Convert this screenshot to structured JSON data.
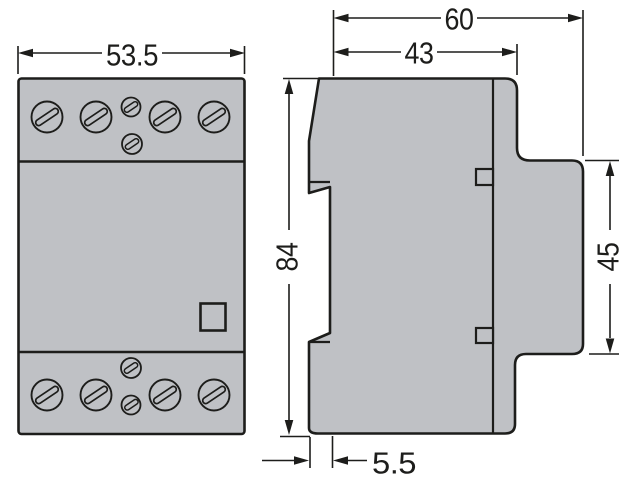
{
  "drawing": {
    "kind": "technical-dimension-drawing",
    "subject": "modular-contactor-outline",
    "colors": {
      "body_fill": "#bfc1c5",
      "line": "#1d1d1b",
      "background": "#ffffff"
    },
    "views": {
      "front": {
        "label": "front-view",
        "top_terminal_large_screws": 4,
        "top_terminal_small_screws": 2,
        "bottom_terminal_large_screws": 4,
        "bottom_terminal_small_screws": 2
      },
      "side": {
        "label": "side-view"
      }
    },
    "dimensions": {
      "front_width": "53.5",
      "side_overall_width": "60",
      "side_upper_width": "43",
      "side_height": "84",
      "side_right_height": "45",
      "side_foot_offset": "5.5"
    }
  }
}
